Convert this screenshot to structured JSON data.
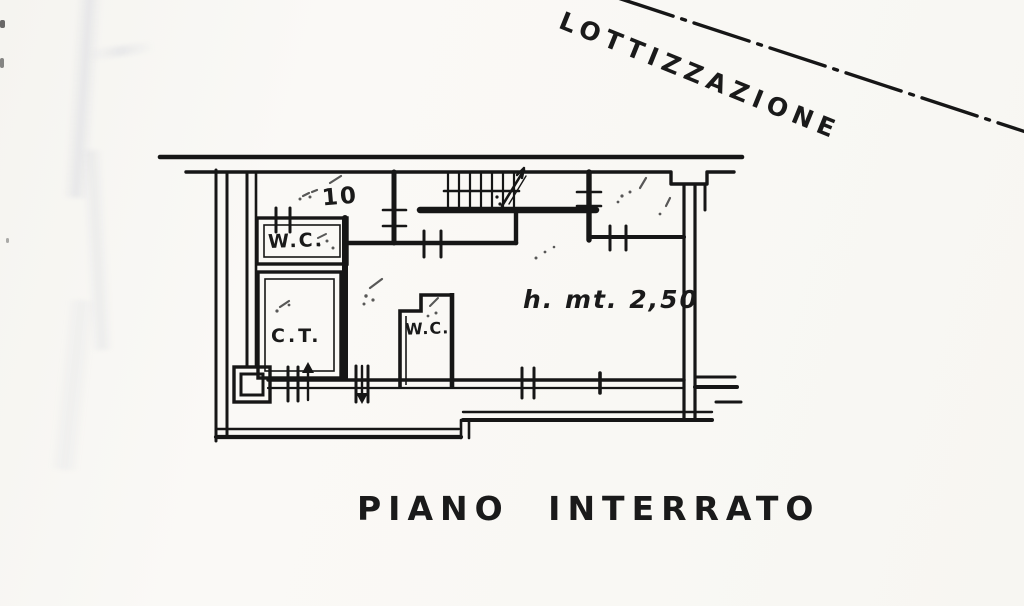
{
  "page": {
    "boundary_label": "LOTTIZZAZIONE",
    "caption": "PIANO INTERRATO",
    "labels": {
      "room_number": "10",
      "wc_upper": "W.C.",
      "ct_room": "C.T.",
      "wc_lower": "W.C.",
      "ceiling_height": "h. mt. 2,50"
    },
    "colors": {
      "paper": "#f9f8f4",
      "ink": "#161616",
      "pencil": "#3c3c3c",
      "crease": "#949cb6"
    }
  }
}
